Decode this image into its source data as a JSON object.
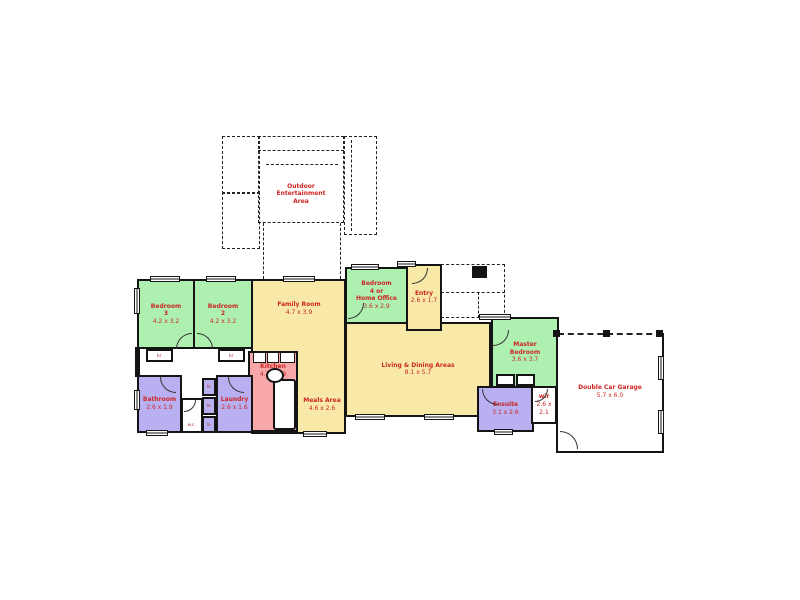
{
  "rooms": {
    "bedroom3": {
      "title": "Bedroom\n3",
      "dims": "4.2 x 3.2"
    },
    "bedroom2": {
      "title": "Bedroom\n2",
      "dims": "4.2 x 3.2"
    },
    "family": {
      "title": "Family Room",
      "dims": "4.7 x 3.9"
    },
    "meals": {
      "title": "Meals Area",
      "dims": "4.6 x 2.6"
    },
    "kitchen": {
      "title": "Kitchen",
      "dims": "4.7 x 2.9"
    },
    "bedroom4": {
      "title": "Bedroom\n4 or\nHome Office",
      "dims": "3.6 x 2.9"
    },
    "entry": {
      "title": "Entry",
      "dims": "2.6 x 1.7"
    },
    "living": {
      "title": "Living & Dining Areas",
      "dims": "8.1 x 5.7"
    },
    "master": {
      "title": "Master\nBedroom",
      "dims": "3.6 x 3.7"
    },
    "ensuite": {
      "title": "Ensuite",
      "dims": "3.1 x 2.6"
    },
    "wir": {
      "title": "wir",
      "dims": "2.6 x 2.1"
    },
    "bathroom": {
      "title": "Bathroom",
      "dims": "2.6 x 1.9"
    },
    "laundry": {
      "title": "Laundry",
      "dims": "2.6 x 1.6"
    },
    "garage": {
      "title": "Double Car Garage",
      "dims": "5.7 x 6.0"
    },
    "outdoor": {
      "title": "Outdoor\nEntertainment\nArea"
    }
  },
  "closets": {
    "br": "br",
    "ln": "ln",
    "wc": "w.c."
  },
  "colors": {
    "bedroom": "#aef0b0",
    "living_area": "#f8e9a8",
    "kitchen": "#f8a8a8",
    "wet_area": "#b8b0f0",
    "wall": "#141414",
    "label": "#cc2525",
    "dash": "#222222",
    "background": "#ffffff"
  }
}
